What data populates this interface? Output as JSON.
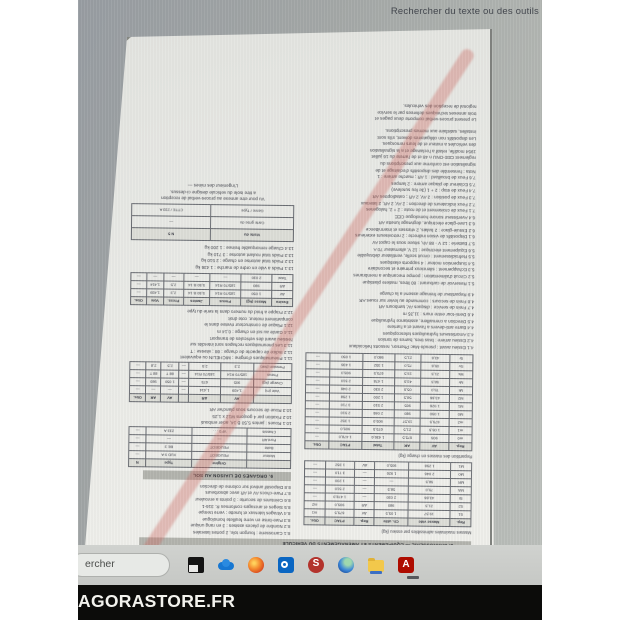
{
  "find_bar": {
    "label": "Rechercher du texte ou des outils"
  },
  "watermark": {
    "label": "AGORASTORE.FR"
  },
  "taskbar": {
    "search_text": "ercher",
    "icons": [
      "task-view",
      "onedrive-cloud",
      "firefox",
      "outlook",
      "red-app",
      "edge-sphere",
      "file-explorer",
      "acrobat"
    ]
  },
  "colors": {
    "screen_gray": "#a4a8a7",
    "page_white": "#e9eae6",
    "cross_stroke": "#cd6960",
    "taskbar_gray": "#c9cbc8",
    "band_black": "#0c0c0a",
    "acrobat_red": "#ae0c00"
  },
  "document": {
    "note": "page affichee tete en bas dans le lecteur PDF",
    "section_band_1": "8. CARROSSERIE — EQUIPEMENTS ET AMENAGEMENTS DU VEHICULE",
    "section_band_2": "9. ORGANES DE LIAISON AU SOL",
    "left_column": {
      "caption_a": "Masses maximales admissibles par essieu (kg)",
      "table_a": [
        [
          "Rep.",
          "Masse vide",
          "Ch. utile",
          "Rep.",
          "PTAC",
          "Obs."
        ],
        [
          "S1",
          "19,57",
          "1 05,5",
          "AV",
          "675,5",
          "m1"
        ],
        [
          "S2",
          "21,5",
          "980",
          "AR",
          "905,0",
          "m2"
        ],
        [
          "St",
          "43,66",
          "2 030",
          "—",
          "1 478,0",
          "—"
        ],
        [
          "MA",
          "75,0",
          "58,5",
          "—",
          "2 510",
          "—"
        ],
        [
          "MR",
          "58,5",
          "—",
          "—",
          "1 200",
          "—"
        ],
        [
          "M0",
          "2 046",
          "1 926",
          "—",
          "3 710",
          "—"
        ],
        [
          "M1",
          "1 258",
          "905,0",
          "AV",
          "1 352",
          "—"
        ]
      ],
      "caption_b": "Repartition des masses en charge (kg)",
      "table_b": [
        [
          "Rep.",
          "AV",
          "AR",
          "Total",
          "PTAC",
          "Obs."
        ],
        [
          "m0",
          "905",
          "675,5",
          "1 436,6",
          "1 478,0",
          "—"
        ],
        [
          "m1",
          "1 05,5",
          "21,5",
          "675,5",
          "905,0",
          "—"
        ],
        [
          "m2",
          "675,5",
          "19,57",
          "905,0",
          "1 352",
          "—"
        ],
        [
          "M0",
          "1 050",
          "980",
          "2 046",
          "2 510",
          "—"
        ],
        [
          "M1",
          "1 926",
          "905",
          "2 510",
          "3 710",
          "—"
        ],
        [
          "M2",
          "43,66",
          "58,5",
          "1 200",
          "1 258",
          "—"
        ],
        [
          "Mt",
          "75,0",
          "05,6",
          "2 030",
          "2 046",
          "—"
        ],
        [
          "Mr",
          "58,5",
          "43,6",
          "1 478",
          "2 510",
          "—"
        ],
        [
          "Ms",
          "21,5",
          "19,5",
          "675,5",
          "905,0",
          "—"
        ],
        [
          "Sv",
          "05,6",
          "75,0",
          "1 352",
          "1 436",
          "—"
        ],
        [
          "Sr",
          "43,6",
          "21,5",
          "980,0",
          "1 050",
          "—"
        ]
      ],
      "paragraphs_1": [
        "4.1  Essieu avant : pseudo-Mac Pherson, ressorts helicoidaux",
        "4.2  Essieu arriere : bras tires, barres de torsion",
        "4.3  Amortisseurs hydrauliques telescopiques",
        "4.4  Barre anti-devers a l'avant et a l'arriere",
        "4.5  Direction a cremaillere, assistance hydraulique",
        "4.6  Demi-tour entre murs : 11,35 m",
        "4.7  Frein de service : disques AV, tambours AR",
        "4.8  Frein de secours : commande au levier sur roues AR",
        "4.9  Repartiteur de freinage asservi a la charge"
      ],
      "paragraphs_2": [
        "5.1  Reservoir de carburant : 80 litres, matiere plastique",
        "5.2  Circuit d'alimentation : pompe mecanique a membranes",
        "5.3  Echappement : silencieux primaire et secondaire",
        "5.4  Suspension moteur : 4 supports elastiques",
        "5.5  Refroidissement : circuit scelle, ventilateur debrayable",
        "5.6  Equipement electrique : 12 V, alternateur 70 A",
        "5.7  Batterie : 12 V - 88 Ah, situee sous le capot AV",
        "6.1  Dispositifs de vision indirecte : 2 retroviseurs exterieurs",
        "6.2  Essuie-glace : 2 balais, 2 vitesses et intermittence",
        "6.3  Lave-glace electrique, degivrage lunette AR",
        "6.4  Avertisseur sonore homologue CEE",
        "7.1  Feux de croisement et de route : 2 + 2, halogenes",
        "7.2  Feux indicateurs de direction : 2 AV, 2 AR, 2 lateraux",
        "7.3  Feux de position : 2 AV, 2 AR ; catadioptres AR",
        "7.4  Feux de stop : 2 + 1 (3e feu sureleve)",
        "7.5  Eclaireur de plaque arriere : 2 lampes",
        "7.6  Feux de brouillard : 1 AR ; marche arriere : 1",
        "Nota : l'ensemble des dispositifs d'eclairage et de",
        "signalisation est conforme aux prescriptions du",
        "reglement CEE-ONU n 48 et de l'arrete du 16 juillet",
        "1954 modifie, relatif a l'eclairage et a la signalisation",
        "des vehicules a moteur et de leurs remorques.",
        "Les dispositifs non obligatoires doivent, s'ils sont",
        "installes, satisfaire aux memes prescriptions."
      ],
      "footer_lines": [
        "Le present proces-verbal comporte deux pages et",
        "trois annexes techniques delivrees par le service",
        "regional de reception des vehicules."
      ]
    },
    "right_column": {
      "lines_1": [
        "8.1  Carrosserie : fourgon tole, 2 portes laterales",
        "8.2  Nombre de places assises : 3 en rang unique",
        "8.3  Pare-brise en verre feuillete homologue",
        "8.4  Vitrages lateraux et lunette : verre trempe",
        "8.5  Sieges et ancrages conformes R. 316-1",
        "8.6  Ceintures de securite : 3 points a enrouleur",
        "8.7  Pare-chocs AV et AR avec absorbeurs",
        "8.8  Dispositif antivol sur colonne de direction"
      ],
      "table_garage": [
        [
          "",
          "Origine",
          "Type",
          "N"
        ],
        [
          "Moteur",
          "PEUGEOT",
          "XUD 9 A",
          "—"
        ],
        [
          "Boite",
          "PEUGEOT",
          "BE 3",
          "—"
        ],
        [
          "Pont AR",
          "—",
          "—",
          "—"
        ],
        [
          "Chassis",
          "VF3 .  .  .",
          "233 A",
          "—"
        ]
      ],
      "lines_2": [
        "10.1  Roues : jantes 5,50 B 14, acier embouti",
        "10.2  Fixation par 4 goujons M12 x 1,25",
        "10.3  Roue de secours sous plancher AR"
      ],
      "table_axles": [
        [
          "",
          "AV",
          "AR",
          "",
          "AV",
          "AR",
          "Obs."
        ],
        [
          "Voie (m)",
          "1,439",
          "1,414",
          "—",
          "—",
          "—",
          "—"
        ],
        [
          "Charge (kg)",
          "905",
          "675",
          "—",
          "1 050",
          "980",
          "—"
        ],
        [
          "Pneus",
          "185/70 R14",
          "185/70 R14",
          "—",
          "88 T",
          "88 T",
          "—"
        ],
        [
          "Pression (bar)",
          "2,3",
          "2,5",
          "—",
          "2,5",
          "2,8",
          "—"
        ]
      ],
      "lines_3": [
        "11.1  Pneumatiques d'origine : MICHELIN ou equivalent",
        "11.2  Indice de capacite de charge : 88 ; vitesse : T",
        "11.3  Les pneumatiques rechapes sont interdits sur",
        "         l'essieu avant des vehicules de transport",
        "11.4  Garde au sol en charge : 0,14 m",
        "12.1  Plaque de constructeur rivetee dans le",
        "         compartiment moteur, cote droit",
        "12.2  Frappe a froid du numero dans la serie du type"
      ],
      "table_tyres": [
        [
          "Essieu",
          "Masse (kg)",
          "Pneus",
          "Jantes",
          "Press.",
          "Voie",
          "Obs."
        ],
        [
          "AV",
          "1 050",
          "185/70 R14",
          "5,50 B 14",
          "2,3",
          "1,439",
          "—"
        ],
        [
          "AR",
          "980",
          "185/70 R14",
          "5,50 B 14",
          "2,5",
          "1,414",
          "—"
        ],
        [
          "Total",
          "2 030",
          "—",
          "—",
          "—",
          "—",
          "—"
        ]
      ],
      "lines_4": [
        "13.1  Poids a vide en ordre de marche : 1 436 kg",
        "13.2  Poids total autorise en charge : 2 510 kg",
        "13.3  Poids total roulant autorise : 3 710 kg",
        "13.4  Charge remorquable freinee : 1 200 kg"
      ],
      "table_visit": [
        [
          "Visite du",
          "N 5"
        ],
        [
          "Carte grise du",
          "—"
        ],
        [
          "Genre / Type",
          "CTTE / 233 A"
        ]
      ],
      "footer_lines": [
        "Vu pour etre annexe au proces-verbal de reception",
        "a titre isole du vehicule designe ci-dessus.",
        "L'ingenieur des mines —"
      ]
    }
  }
}
